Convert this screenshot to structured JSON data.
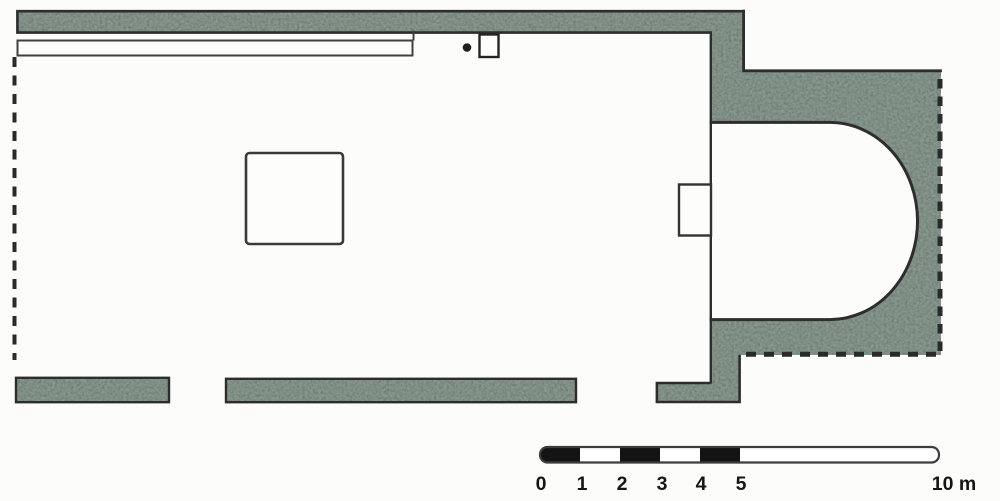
{
  "diagram": {
    "kind": "architectural-floor-plan",
    "subject": "single-nave church plan with eastern apse",
    "texture": "stippled-masonry-walls",
    "elements": [
      "north-wall",
      "north-bench",
      "post-dot",
      "small-square-feature",
      "west-dashed-wall-line",
      "nave",
      "central-square-foundation",
      "chancel-line",
      "pilaster",
      "apse-opening",
      "apse-masonry-block",
      "south-wall-west",
      "south-wall-middle",
      "south-wall-east",
      "scale-bar"
    ]
  },
  "colors": {
    "background": "#fcfcfb",
    "masonry_fill": "#839289",
    "masonry_speckle": "#5c6e63",
    "outline": "#2d2d2d",
    "dashed_edge": "#2a2a2a",
    "scale_bar_black": "#141414",
    "scale_bar_white": "#ffffff"
  },
  "scale_bar": {
    "tick_labels": [
      "0",
      "1",
      "2",
      "3",
      "4",
      "5"
    ],
    "end_label": "10 m",
    "unit": "m",
    "range_m": [
      0,
      10
    ],
    "pattern": "alternating black/white meter segments 0-5, open bar 5-10"
  }
}
